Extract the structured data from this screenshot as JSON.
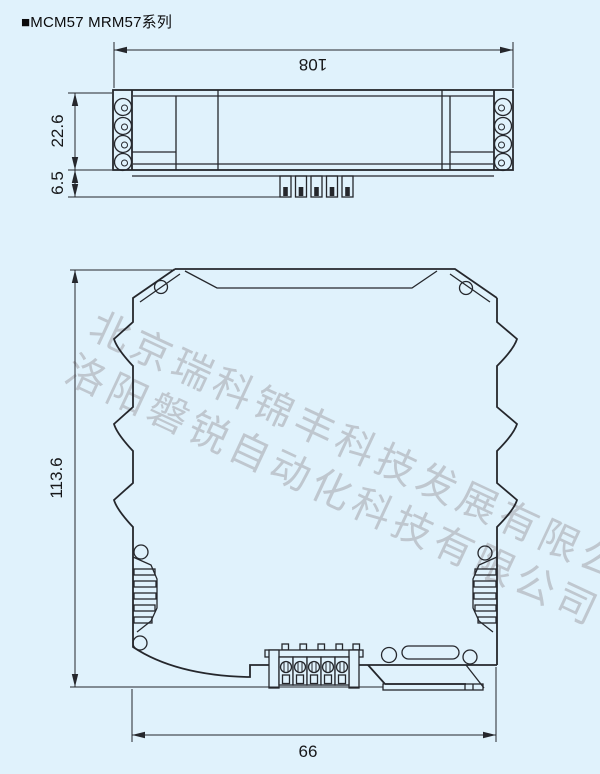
{
  "title": "■MCM57 MRM57系列",
  "watermarks": {
    "line1": "北京瑞科锦丰科技发展有限公司",
    "line2": "洛阳磐锐自动化科技有限公司"
  },
  "colors": {
    "background": "#e0f2fc",
    "line": "#25272c",
    "watermark": "#b6bcc3",
    "dimension_text": "#17181a"
  },
  "top_view": {
    "dimensions": {
      "length": "108",
      "body_height": "22.6",
      "pin_height": "6.5"
    }
  },
  "front_view": {
    "dimensions": {
      "height": "113.6",
      "width": "66"
    }
  }
}
